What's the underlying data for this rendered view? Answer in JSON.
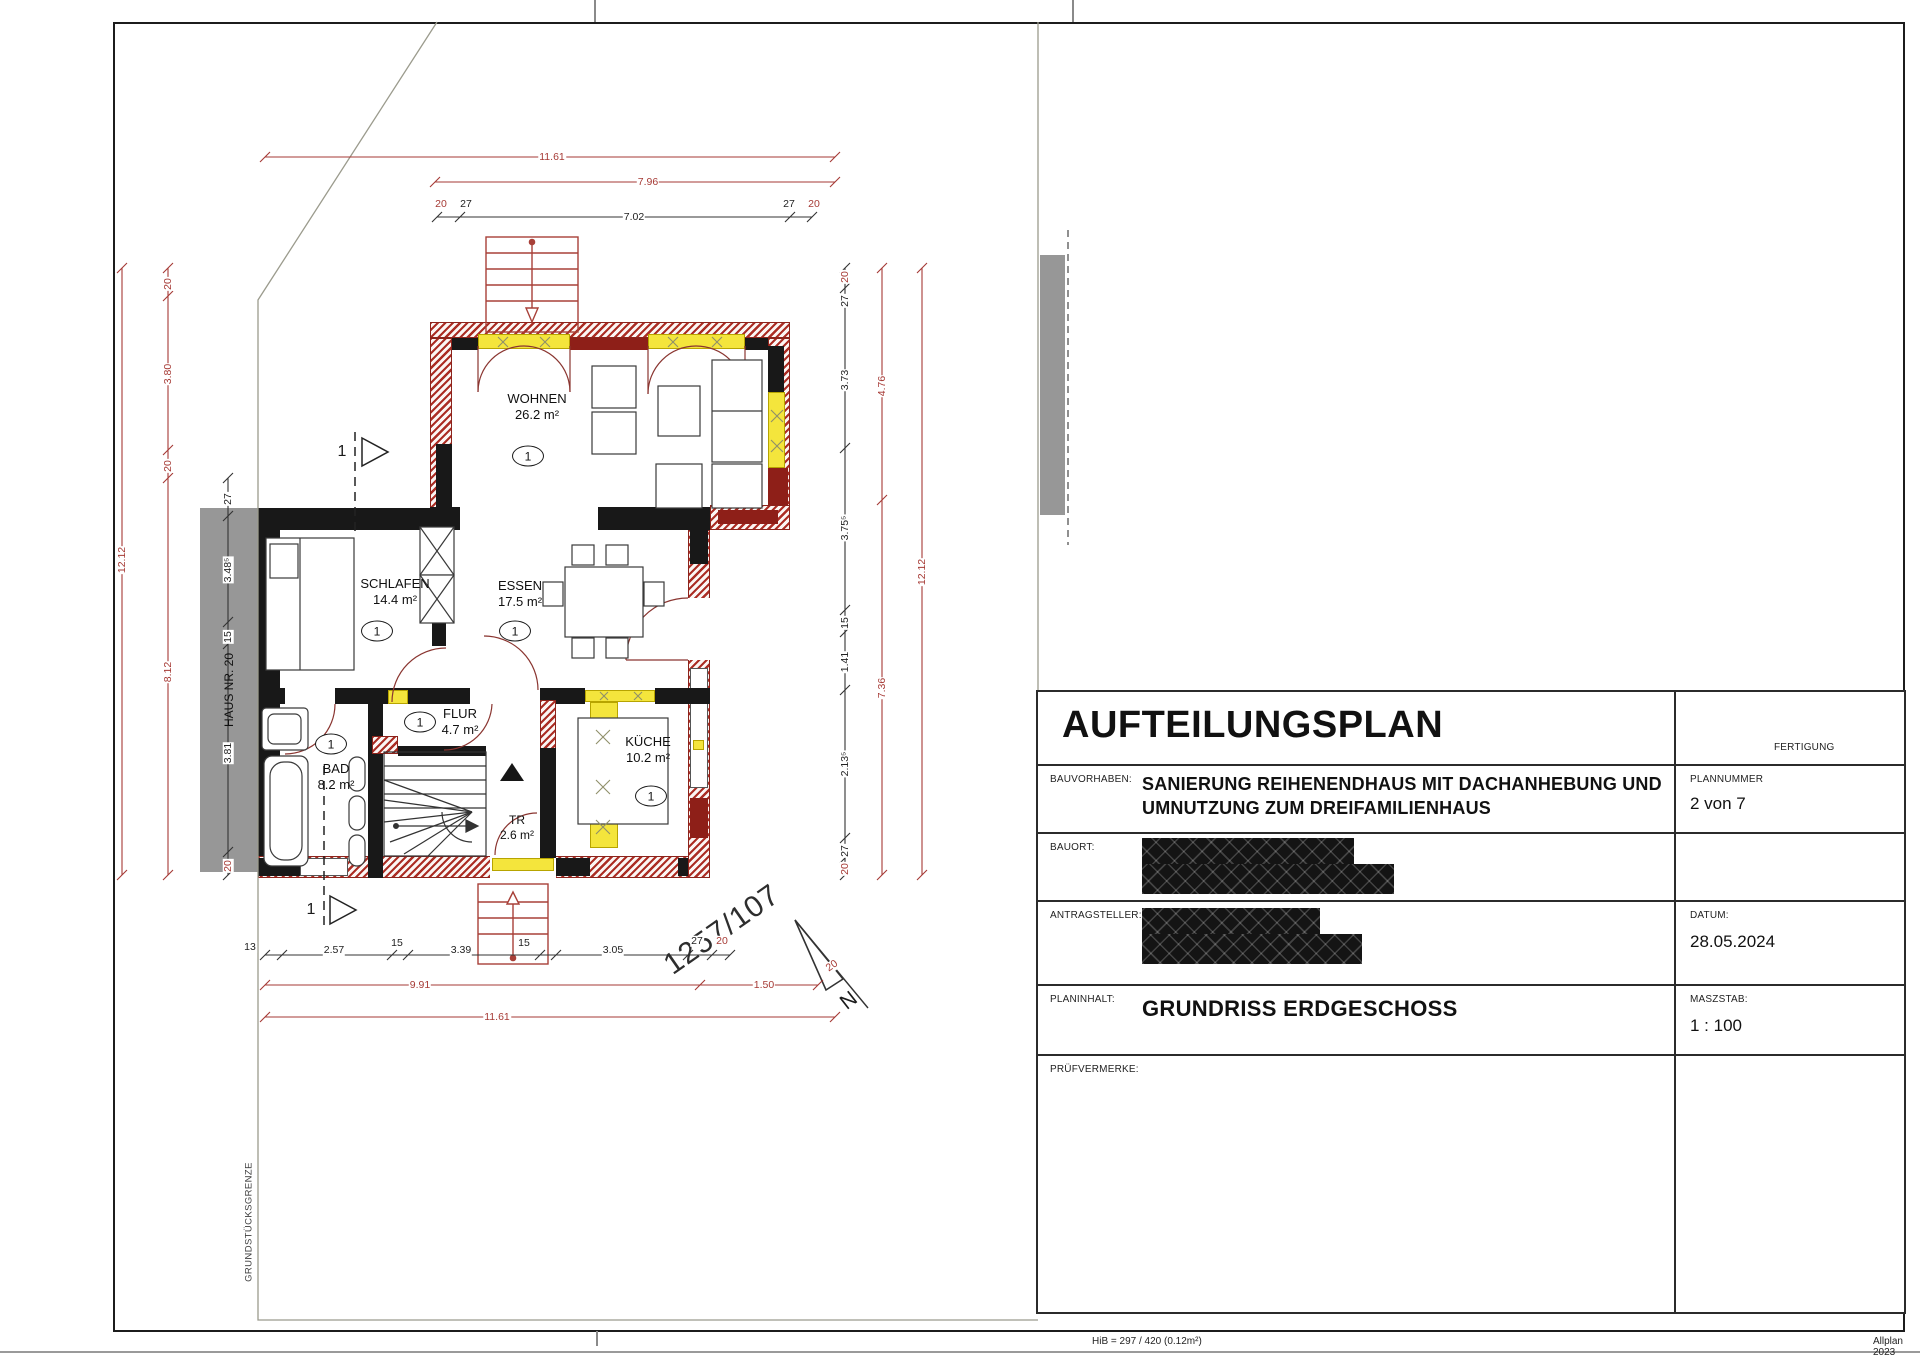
{
  "page": {
    "footer_left": "HiB = 297 / 420 (0.12m²)",
    "footer_right": "Allplan 2023"
  },
  "title_block": {
    "title": "AUFTEILUNGSPLAN",
    "fertigung": "FERTIGUNG",
    "bauvorhaben_label": "BAUVORHABEN:",
    "bauvorhaben_line1": "SANIERUNG REIHENENDHAUS MIT DACHANHEBUNG UND",
    "bauvorhaben_line2": "UMNUTZUNG ZUM DREIFAMILIENHAUS",
    "plannummer_label": "PLANNUMMER",
    "plannummer_value": "2 von 7",
    "bauort_label": "BAUORT:",
    "antragsteller_label": "ANTRAGSTELLER:",
    "datum_label": "DATUM:",
    "datum_value": "28.05.2024",
    "planinhalt_label": "PLANINHALT:",
    "planinhalt_value": "GRUNDRISS ERDGESCHOSS",
    "maszstab_label": "MASZSTAB:",
    "maszstab_value": "1 : 100",
    "pruefvermerke_label": "PRÜFVERMERKE:"
  },
  "plan": {
    "rooms": [
      {
        "name": "WOHNEN",
        "area": "26.2 m²",
        "unit": "1"
      },
      {
        "name": "SCHLAFEN",
        "area": "14.4 m²",
        "unit": "1"
      },
      {
        "name": "ESSEN",
        "area": "17.5 m²",
        "unit": "1"
      },
      {
        "name": "FLUR",
        "area": "4.7 m²",
        "unit": "1"
      },
      {
        "name": "BAD",
        "area": "8.2 m²",
        "unit": "1"
      },
      {
        "name": "KÜCHE",
        "area": "10.2 m²",
        "unit": "1"
      },
      {
        "name": "TR",
        "area": "2.6 m²"
      }
    ],
    "labels": {
      "haus_nr": "HAUS NR. 20",
      "grenze": "GRUNDSTÜCKSGRENZE",
      "parzelle": "1257/107",
      "north": "N",
      "section_top": "1",
      "section_bottom": "1"
    },
    "dimensions": {
      "top": {
        "total": "11.61",
        "outer": "7.96",
        "inner": "7.02",
        "left_ticks": [
          "20",
          "27"
        ],
        "right_ticks": [
          "27",
          "20"
        ]
      },
      "left": {
        "total": "12.12",
        "red": [
          "20",
          "3.80",
          "20",
          "8.12"
        ],
        "black": [
          "27",
          "3.48⁵",
          "15",
          "3.81",
          "20"
        ]
      },
      "right": {
        "total": "12.12",
        "red": [
          "4.76",
          "7.36"
        ],
        "black": [
          "20",
          "27",
          "3.73",
          "3.75⁵",
          "15",
          "1.41",
          "2.13⁵",
          "27",
          "20"
        ]
      },
      "bottom": {
        "total": "11.61",
        "red": [
          "9.91",
          "1.50",
          "20"
        ],
        "black": [
          "13",
          "2.57",
          "15",
          "3.39",
          "15",
          "3.05",
          "27",
          "20"
        ]
      }
    }
  }
}
